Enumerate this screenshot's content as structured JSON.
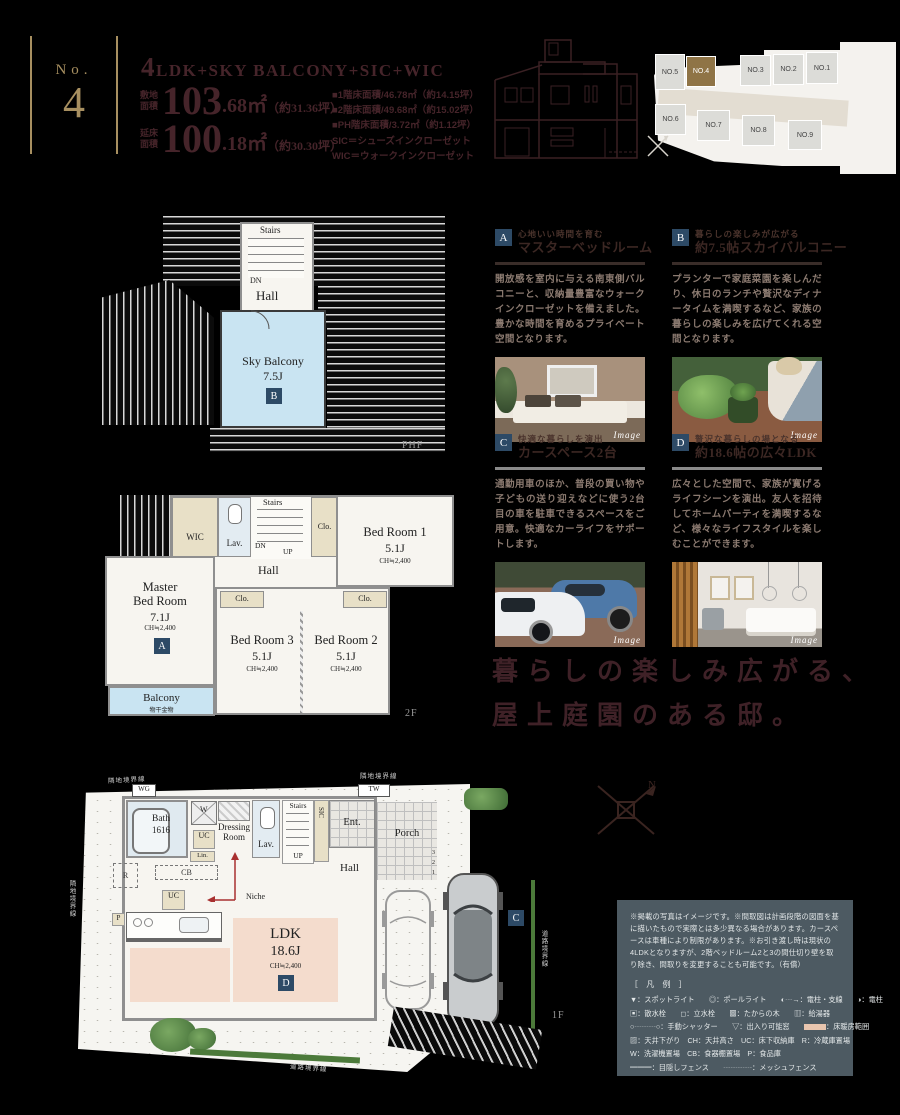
{
  "header": {
    "no_label": "No.",
    "no_number": "4",
    "title_num": "4",
    "title_rest": "LDK+SKY BALCONY+SIC+WIC",
    "land_label": "敷地\n面積",
    "land_int": "103",
    "land_dec": ".68㎡",
    "land_tsubo": "（約31.36坪）",
    "floor_label": "延床\n面積",
    "floor_int": "100",
    "floor_dec": ".18㎡",
    "floor_tsubo": "（約30.30坪）",
    "details": [
      "■1階床面積/46.78㎡（約14.15坪）",
      "■2階床面積/49.68㎡（約15.02坪）",
      "■PH階床面積/3.72㎡（約1.12坪）",
      "SIC＝シューズインクローゼット",
      "WIC＝ウォークインクローゼット"
    ]
  },
  "sitemap": {
    "lots": [
      "NO.1",
      "NO.2",
      "NO.3",
      "NO.4",
      "NO.5",
      "NO.6",
      "NO.7",
      "NO.8",
      "NO.9"
    ]
  },
  "features": [
    {
      "id": "A",
      "tag": "心地いい時間を育む",
      "title": "マスターベッドルーム",
      "body": "開放感を室内に与える南東側バルコニーと、収納量豊富なウォークインクローゼットを備えました。豊かな時間を育めるプライベート空間となります。",
      "image_label": "Image"
    },
    {
      "id": "B",
      "tag": "暮らしの楽しみが広がる",
      "title": "約7.5帖スカイバルコニー",
      "body": "プランターで家庭菜園を楽しんだり、休日のランチや贅沢なディナータイムを満喫するなど、家族の暮らしの楽しみを広げてくれる空間となります。",
      "image_label": "Image"
    },
    {
      "id": "C",
      "tag": "快適な暮らしを演出",
      "title": "カースペース2台",
      "body": "通勤用車のほか、普段の買い物や子どもの送り迎えなどに使う2台目の車を駐車できるスペースをご用意。快適なカーライフをサポートします。",
      "image_label": "Image"
    },
    {
      "id": "D",
      "tag": "贅沢な暮らしの場となる",
      "title": "約18.6帖の広々LDK",
      "body": "広々とした空間で、家族が寛げるライフシーンを演出。友人を招待してホームパーティを満喫するなど、様々なライフスタイルを楽しむことができます。",
      "image_label": "Image"
    }
  ],
  "catchphrase": {
    "line1": "暮らしの楽しみ広がる、",
    "line2": "屋上庭園のある邸。"
  },
  "plan_phf": {
    "stairs": "Stairs",
    "dn": "DN",
    "hall": "Hall",
    "room": "Sky Balcony",
    "size": "7.5J",
    "badge": "B",
    "floor": "PHF"
  },
  "plan_2f": {
    "wic": "WIC",
    "lav": "Lav.",
    "stairs": "Stairs",
    "dn": "DN",
    "up": "UP",
    "hall": "Hall",
    "clo": "Clo.",
    "bed1": "Bed Room 1",
    "bed1_size": "5.1J",
    "ch": "CH≒2,400",
    "master1": "Master",
    "master2": "Bed Room",
    "master_size": "7.1J",
    "badge_a": "A",
    "bed3": "Bed Room 3",
    "bed3_size": "5.1J",
    "bed2": "Bed Room 2",
    "bed2_size": "5.1J",
    "balcony": "Balcony",
    "hoshi": "物干金物",
    "floor": "2F"
  },
  "plan_1f": {
    "wg": "WG",
    "bath": "Bath",
    "bath_size": "1616",
    "w": "W",
    "dress1": "Dressing",
    "dress2": "Room",
    "uc": "UC",
    "lin": "Lin.",
    "lav": "Lav.",
    "stairs": "Stairs",
    "up": "UP",
    "sic": "SIC",
    "tw": "TW",
    "ent": "Ent.",
    "porch": "Porch",
    "hall": "Hall",
    "niche": "Niche",
    "r": "R",
    "cb": "CB",
    "p": "P",
    "ldk": "LDK",
    "ldk_size": "18.6J",
    "ch": "CH≒2,400",
    "badge_c": "C",
    "badge_d": "D",
    "floor": "1F",
    "steps": [
      "3",
      "2",
      "1"
    ],
    "compass_n": "N",
    "boundary_top": "隣地境界線",
    "boundary_top2": "隣地境界線",
    "boundary_left": "隣地境界線",
    "boundary_road": "道路境界線",
    "boundary_road2": "道路境界線"
  },
  "legend": {
    "disclaimer": "※掲載の写真はイメージです。※間取図は計画段階の図面を基に描いたもので実際とは多少異なる場合があります。カースペースは車種により制限があります。※お引き渡し時は現状の4LDKとなりますが、2階ベッドルーム2と3の間仕切り壁を取り除き、間取りを変更することも可能です。（有償）",
    "title": "［ 凡 例 ］",
    "rows": [
      "▼：スポットライト　　◎：ポールライト　　◐┄→：電柱・支線　　◑：電柱",
      "▣：散水栓　　◻：立水栓　　▩：たからの木　　▥：給湯器",
      "▨：天井下がり　CH：天井高さ　UC：床下収納庫　R：冷蔵庫置場",
      "W：洗濯機置場　CB：食器棚置場　P：食品庫",
      "━━━：目隠しフェンス　　┄┄┄┄：メッシュフェンス"
    ],
    "row_shutter": "○┄┄┄○：手動シャッター　　▽：出入り可能窓　　",
    "row_floorheat": "：床暖房範囲"
  }
}
